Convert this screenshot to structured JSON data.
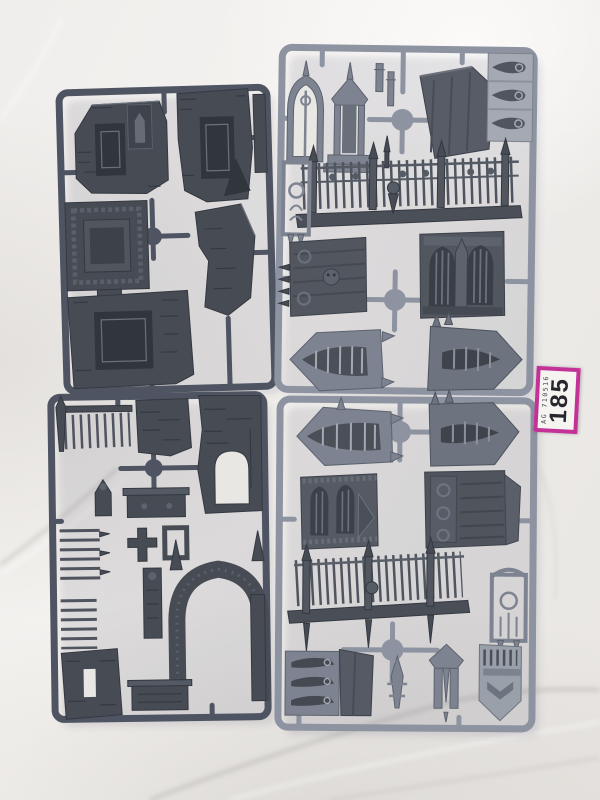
{
  "label": {
    "code": "AG 710516",
    "number": "185"
  },
  "colors": {
    "background": "#efedea",
    "frame_dark": "#4e5462",
    "frame_light": "#8d93a0",
    "piece_dark": "#474c54",
    "piece_mid": "#7d8390",
    "piece_light": "#a4a9b3",
    "fence_dark": "#4f545e",
    "label_border": "#c23297",
    "label_bg": "#f6f4f1",
    "label_text": "#26262e"
  }
}
